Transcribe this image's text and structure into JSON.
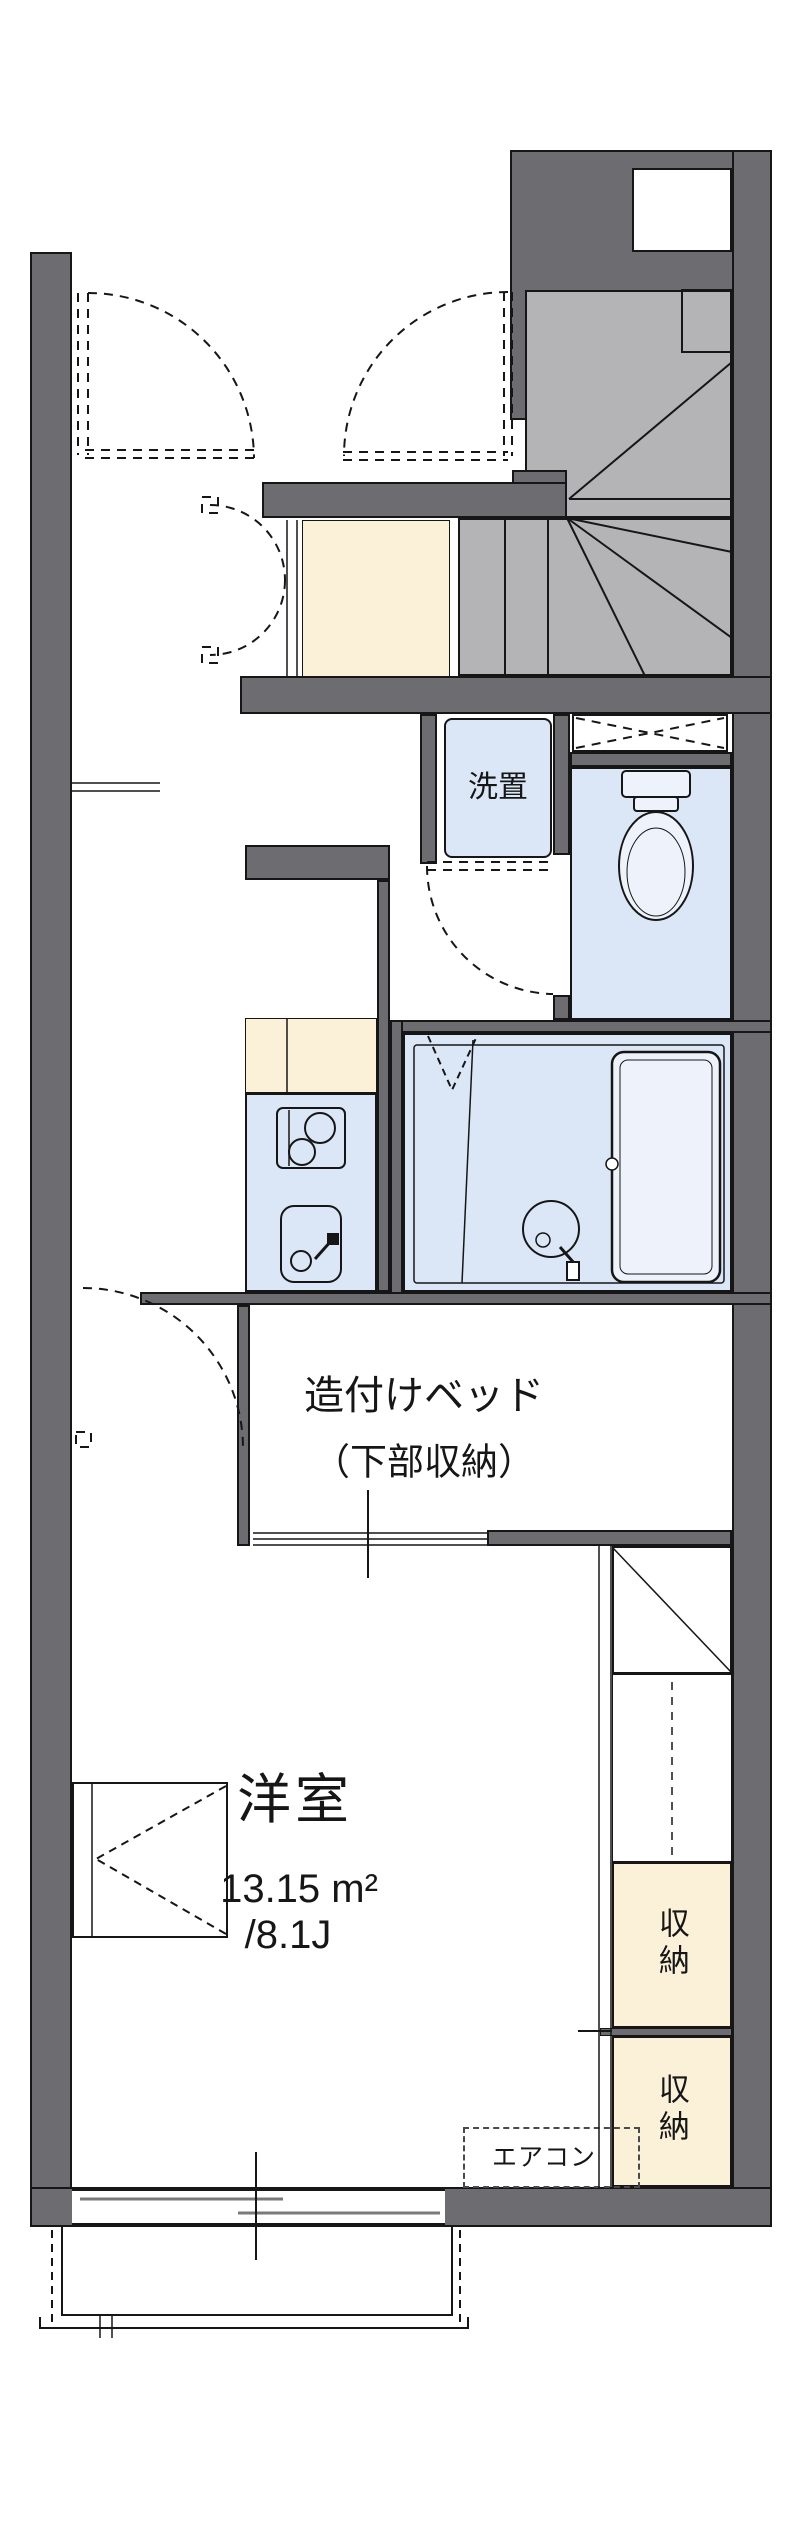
{
  "floorplan": {
    "labels": {
      "washer": "洗置",
      "bed_title": "造付けベッド",
      "bed_sub": "（下部収納）",
      "room_name": "洋室",
      "room_area": "13.15 m²",
      "room_size_jo": "/8.1J",
      "storage_upper": "収納",
      "storage_lower": "収納",
      "aircon": "エアコン"
    },
    "colors": {
      "wall": "#6d6d71",
      "stair": "#b4b4b6",
      "water": "#dbe7f7",
      "fixture": "#eef3fb",
      "cream": "#fbf1d9",
      "line": "#161616"
    }
  }
}
